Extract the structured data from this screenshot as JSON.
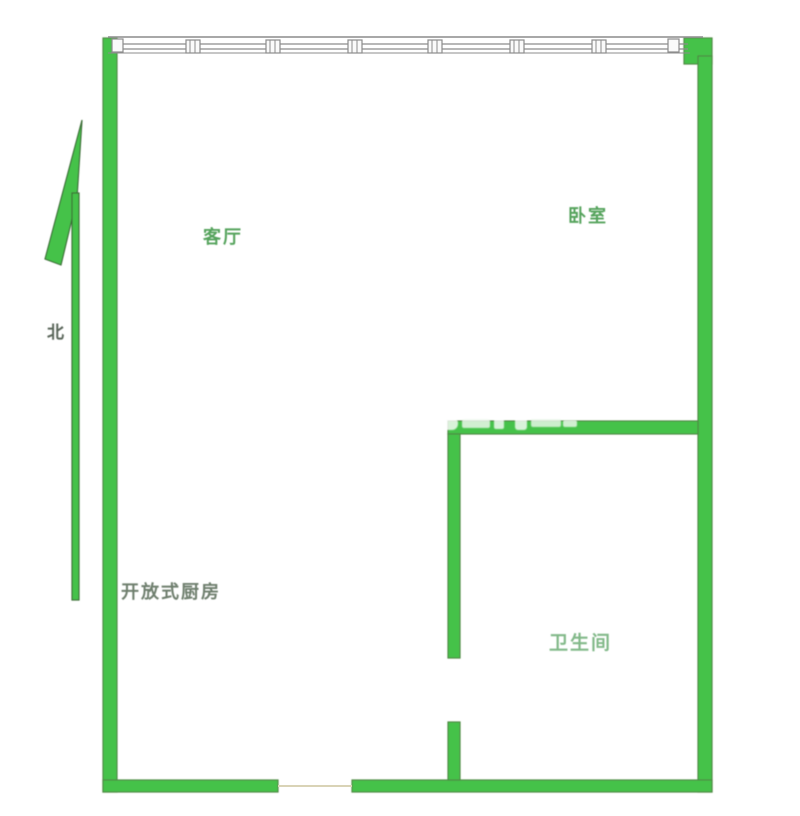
{
  "floorplan": {
    "rooms": {
      "living_room": {
        "label": "客厅"
      },
      "bedroom": {
        "label": "卧室"
      },
      "open_kitchen": {
        "label": "开放式厨房"
      },
      "bathroom": {
        "label": "卫生间"
      }
    },
    "compass": {
      "north_label": "北"
    },
    "colors": {
      "wall_fill": "#45c24a",
      "wall_outline": "#4f8a44",
      "window_line": "#8c8c8c",
      "living_bedroom_label": "#55a35c",
      "kitchen_label": "#6f7f6e",
      "bathroom_label": "#82b989",
      "north_label": "#5a665a",
      "watermark": "rgba(255,255,255,0.78)"
    }
  }
}
